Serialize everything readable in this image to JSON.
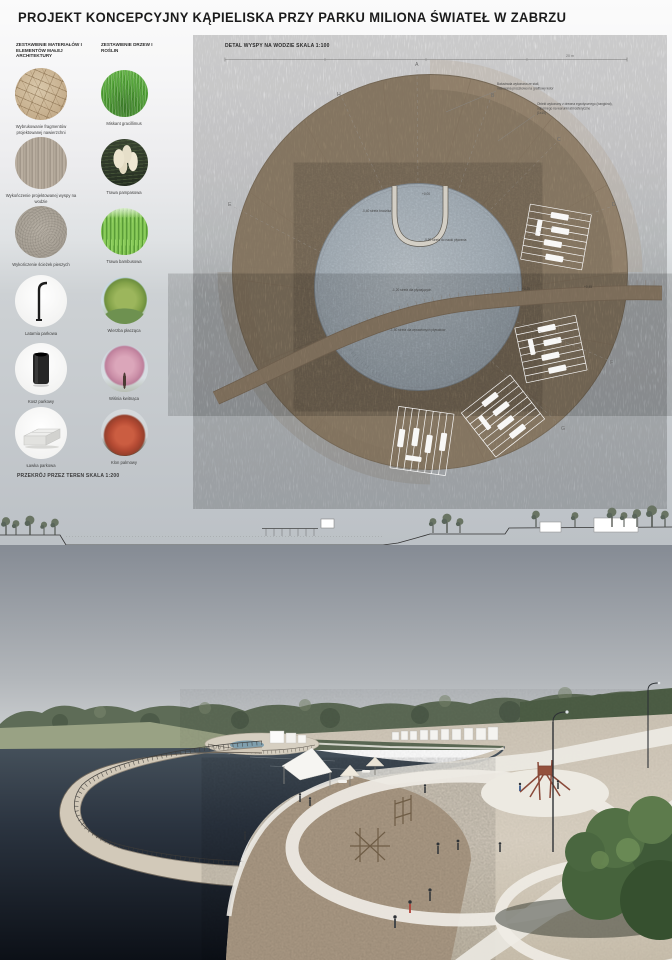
{
  "title": "PROJEKT KONCEPCYJNY KĄPIELISKA PRZY PARKU MILIONA ŚWIATEŁ W ZABRZU",
  "legend": {
    "materials": {
      "header": "ZESTAWIENIE MATERIAŁÓW I ELEMENTÓW MAŁEJ ARCHITEKTURY",
      "items": [
        {
          "name": "stone-paving",
          "label": "Wybrukowanie fragmentów projektowanej nawierzchni"
        },
        {
          "name": "wood-decking",
          "label": "Wykończenie projektowanej wyspy na wodzie"
        },
        {
          "name": "concrete-paths",
          "label": "Wykończenie ścieżek pieszych"
        },
        {
          "name": "park-lantern",
          "label": "Latarnia parkowa"
        },
        {
          "name": "park-bin",
          "label": "Kosz parkowy"
        },
        {
          "name": "park-bench",
          "label": "Ławka parkowa"
        }
      ]
    },
    "plants": {
      "header": "ZESTAWIENIE DRZEW I ROŚLIN",
      "items": [
        {
          "name": "miscanthus",
          "label": "Miskant gracillimus"
        },
        {
          "name": "pampas-grass",
          "label": "Trawa pampasowa"
        },
        {
          "name": "bamboo-grass",
          "label": "Trawa bambusowa"
        },
        {
          "name": "weeping-willow",
          "label": "Wierzba płacząca"
        },
        {
          "name": "flowering-cherry",
          "label": "Wiśnia kwitnąca"
        },
        {
          "name": "palmate-maple",
          "label": "Klon palmowy"
        }
      ]
    }
  },
  "plan": {
    "title": "DETAL WYSPY NA WODZIE SKALA 1:100",
    "scale_bar_label": "20 m",
    "annotations": [
      {
        "lines": [
          "Balustrada wykonana ze stali,",
          "malowana proszkowo na grafitowy kolor"
        ]
      },
      {
        "lines": [
          "Obiekt wykonany z drewna egzotycznego (bangkirai),",
          "odpornego na warunki atmosferyczne",
          "(1x10)"
        ]
      }
    ],
    "water_labels": [
      "+0,00",
      "-0,40 strefa brodzika",
      "-0,90 strefa do nauki pływania",
      "-1,20 strefa dla pływających",
      "-1,50 strefa dla wprawionych pływaków"
    ],
    "deck_labels": [
      "+0,25",
      "+0,45"
    ],
    "section_markers": [
      "A",
      "B",
      "C",
      "D",
      "E",
      "F",
      "G",
      "H"
    ]
  },
  "section": {
    "title": "PRZEKRÓJ PRZEZ TEREN SKALA 1:200"
  },
  "colors": {
    "deck_wood": "#a29077",
    "plan_water": "#b6c0c9",
    "lake_water": "#151b24",
    "sand": "#ddd4c5",
    "sky": "#8f959d",
    "tower_red": "#8a4a3a"
  }
}
